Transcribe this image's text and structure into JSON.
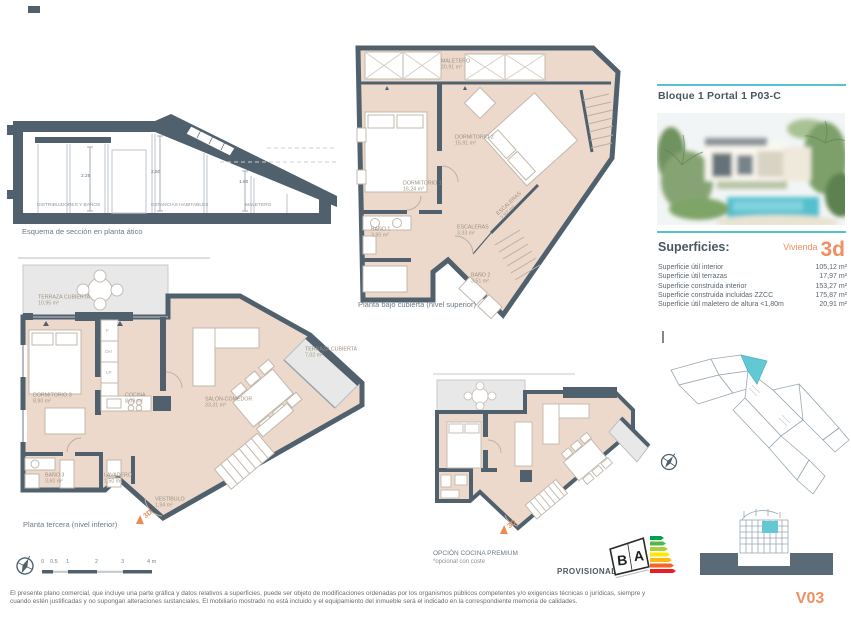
{
  "colors": {
    "wall": "#50606d",
    "floor": "#ecd9cb",
    "terrace": "#e8e8e8",
    "teal": "#55c2cd",
    "orange": "#ef8f63"
  },
  "section": {
    "caption": "Esquema de sección en planta ático",
    "zones": [
      {
        "name": "DISTRIBUIDORES Y BAÑOS",
        "height": "2.25"
      },
      {
        "name": "ESTANCIAS HABITABLES",
        "height": "2.50"
      },
      {
        "name": "MALETERO",
        "height": "1.80"
      }
    ]
  },
  "plan_upper": {
    "caption": "Planta bajo cubierta (nivel superior)",
    "rooms": [
      {
        "name": "MALETERO",
        "area": "20,91 m²"
      },
      {
        "name": "DORMITORIO 1",
        "area": "16,24 m²"
      },
      {
        "name": "DORMITORIO 2",
        "area": "15,91 m²"
      },
      {
        "name": "BAÑO 1",
        "area": "3,95 m²"
      },
      {
        "name": "ESCALERAS",
        "area": "3,33 m²"
      },
      {
        "name": "ESCALERAS",
        "area": "2,97 m²"
      },
      {
        "name": "BAÑO 2",
        "area": "3,51 m²"
      }
    ]
  },
  "plan_lower": {
    "caption": "Planta tercera (nivel inferior)",
    "rooms": [
      {
        "name": "TERRAZA CUBIERTA",
        "area": "10,95 m²"
      },
      {
        "name": "DORMITORIO 3",
        "area": "8,90 m²"
      },
      {
        "name": "COCINA",
        "area": "8,09 m²"
      },
      {
        "name": "SALÓN-COMEDOR",
        "area": "33,31 m²"
      },
      {
        "name": "TERRAZA CUBIERTA",
        "area": "7,02 m²"
      },
      {
        "name": "BAÑO 3",
        "area": "3,60 m²"
      },
      {
        "name": "LAVADERO",
        "area": "1,50 m²"
      },
      {
        "name": "VESTÍBULO",
        "area": "1,94 m²"
      }
    ],
    "appliance_codes": [
      "F",
      "OH",
      "LP"
    ]
  },
  "plan_premium": {
    "caption": "OPCIÓN COCINA PREMIUM",
    "note": "*opcional con coste"
  },
  "marker_3d": "3D",
  "panel": {
    "title": "Bloque 1 Portal 1 P03-C",
    "superficies_label": "Superficies:",
    "vivienda_label": "Vivienda",
    "vivienda_code": "3d",
    "rows": [
      {
        "label": "Superficie útil interior",
        "value": "105,12 m²"
      },
      {
        "label": "Superficie útil terrazas",
        "value": "17,97 m²"
      },
      {
        "label": "Superficie construida interior",
        "value": "153,27 m²"
      },
      {
        "label": "Superficie construida incluidas ZZCC",
        "value": "175,87 m²"
      },
      {
        "label": "Superficie útil maletero de altura <1,80m",
        "value": "20,91 m²"
      }
    ]
  },
  "scalebar": {
    "ticks": [
      "0",
      "0.5",
      "1",
      "2",
      "3",
      "4 m"
    ]
  },
  "footer": {
    "provisional": "PROVISIONAL",
    "energy_b": "B",
    "energy_a": "A",
    "disclaimer1": "El presente plano comercial, que incluye una parte gráfica y datos relativos a superficies, puede ser objeto de modificaciones ordenadas por los organismos públicos competentes y/o exigencias técnicas o jurídicas, siempre y",
    "disclaimer2": "cuando estén justificadas y no supongan alteraciones sustanciales. El mobiliario mostrado no está incluido y el equipamiento del inmueble será el indicado en la correspondiente memoria de calidades.",
    "version": "V03"
  }
}
